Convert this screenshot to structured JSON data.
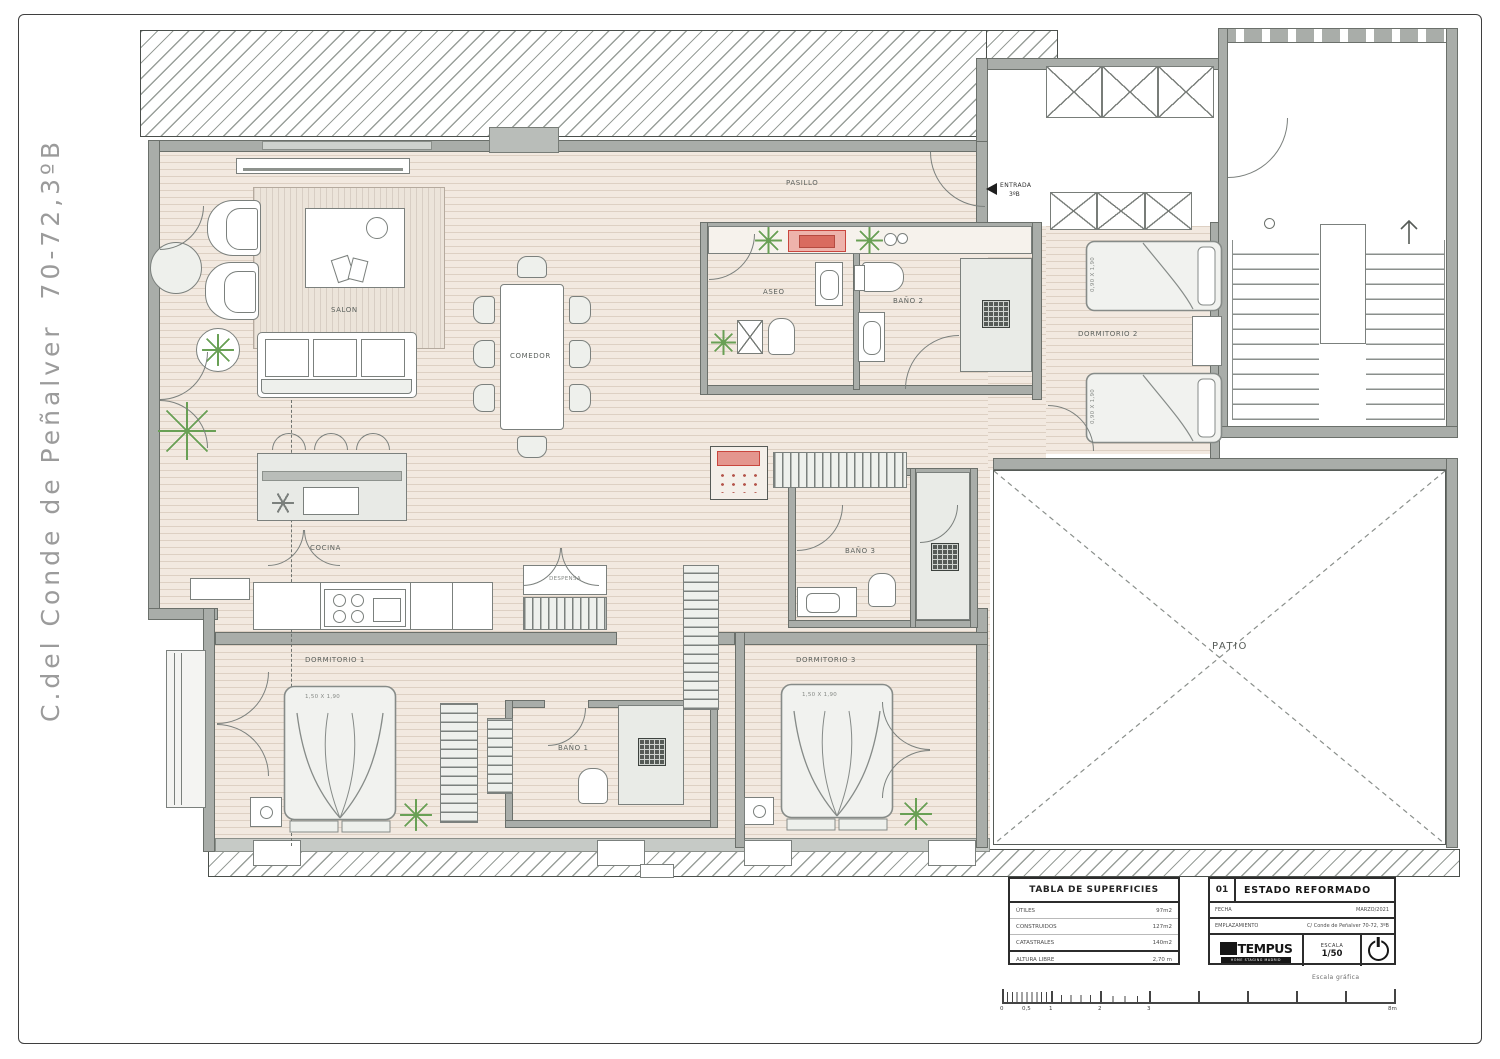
{
  "street_label": "C.del Conde de Peñalver  70-72,3ºB",
  "rooms": {
    "salon": "SALON",
    "comedor": "COMEDOR",
    "cocina": "COCINA",
    "despensa": "DESPENSA",
    "pasillo": "PASILLO",
    "aseo": "ASEO",
    "bano1": "BAÑO 1",
    "bano2": "BAÑO 2",
    "bano3": "BAÑO 3",
    "dorm1": "DORMITORIO 1",
    "dorm2": "DORMITORIO 2",
    "dorm3": "DORMITORIO 3",
    "patio": "PATIO"
  },
  "entrance": {
    "label": "ENTRADA",
    "unit": "3ºB"
  },
  "beds": {
    "double_size": "1,50 X 1,90",
    "single_size": "0,90 X 1,90"
  },
  "surface_table": {
    "title": "TABLA DE SUPERFICIES",
    "rows": [
      {
        "label": "ÚTILES",
        "value": "97m2"
      },
      {
        "label": "CONSTRUIDOS",
        "value": "127m2"
      },
      {
        "label": "CATASTRALES",
        "value": "140m2"
      }
    ],
    "footer_label": "ALTURA LIBRE",
    "footer_value": "2,70 m"
  },
  "title_block": {
    "sheet_number": "01",
    "title": "ESTADO REFORMADO",
    "date_label": "FECHA",
    "date_value": "MARZO/2021",
    "location_label": "EMPLAZAMIENTO",
    "location_value": "C/ Conde de Peñalver 70-72, 3ºB",
    "logo_text": "TEMPUS",
    "logo_subtext": "HOME STAGING MADRID",
    "scale_label": "ESCALA",
    "scale_value": "1/50"
  },
  "scale_bar": {
    "caption": "Escala gráfica",
    "labels": {
      "l0": "0",
      "l05": "0,5",
      "l1": "1",
      "l2": "2",
      "l3": "3",
      "l8": "8m"
    }
  },
  "colors": {
    "wall": "#a9ada9",
    "floor": "#f2e9e0",
    "accent_red": "#c9463d",
    "plant_green": "#69a055"
  }
}
